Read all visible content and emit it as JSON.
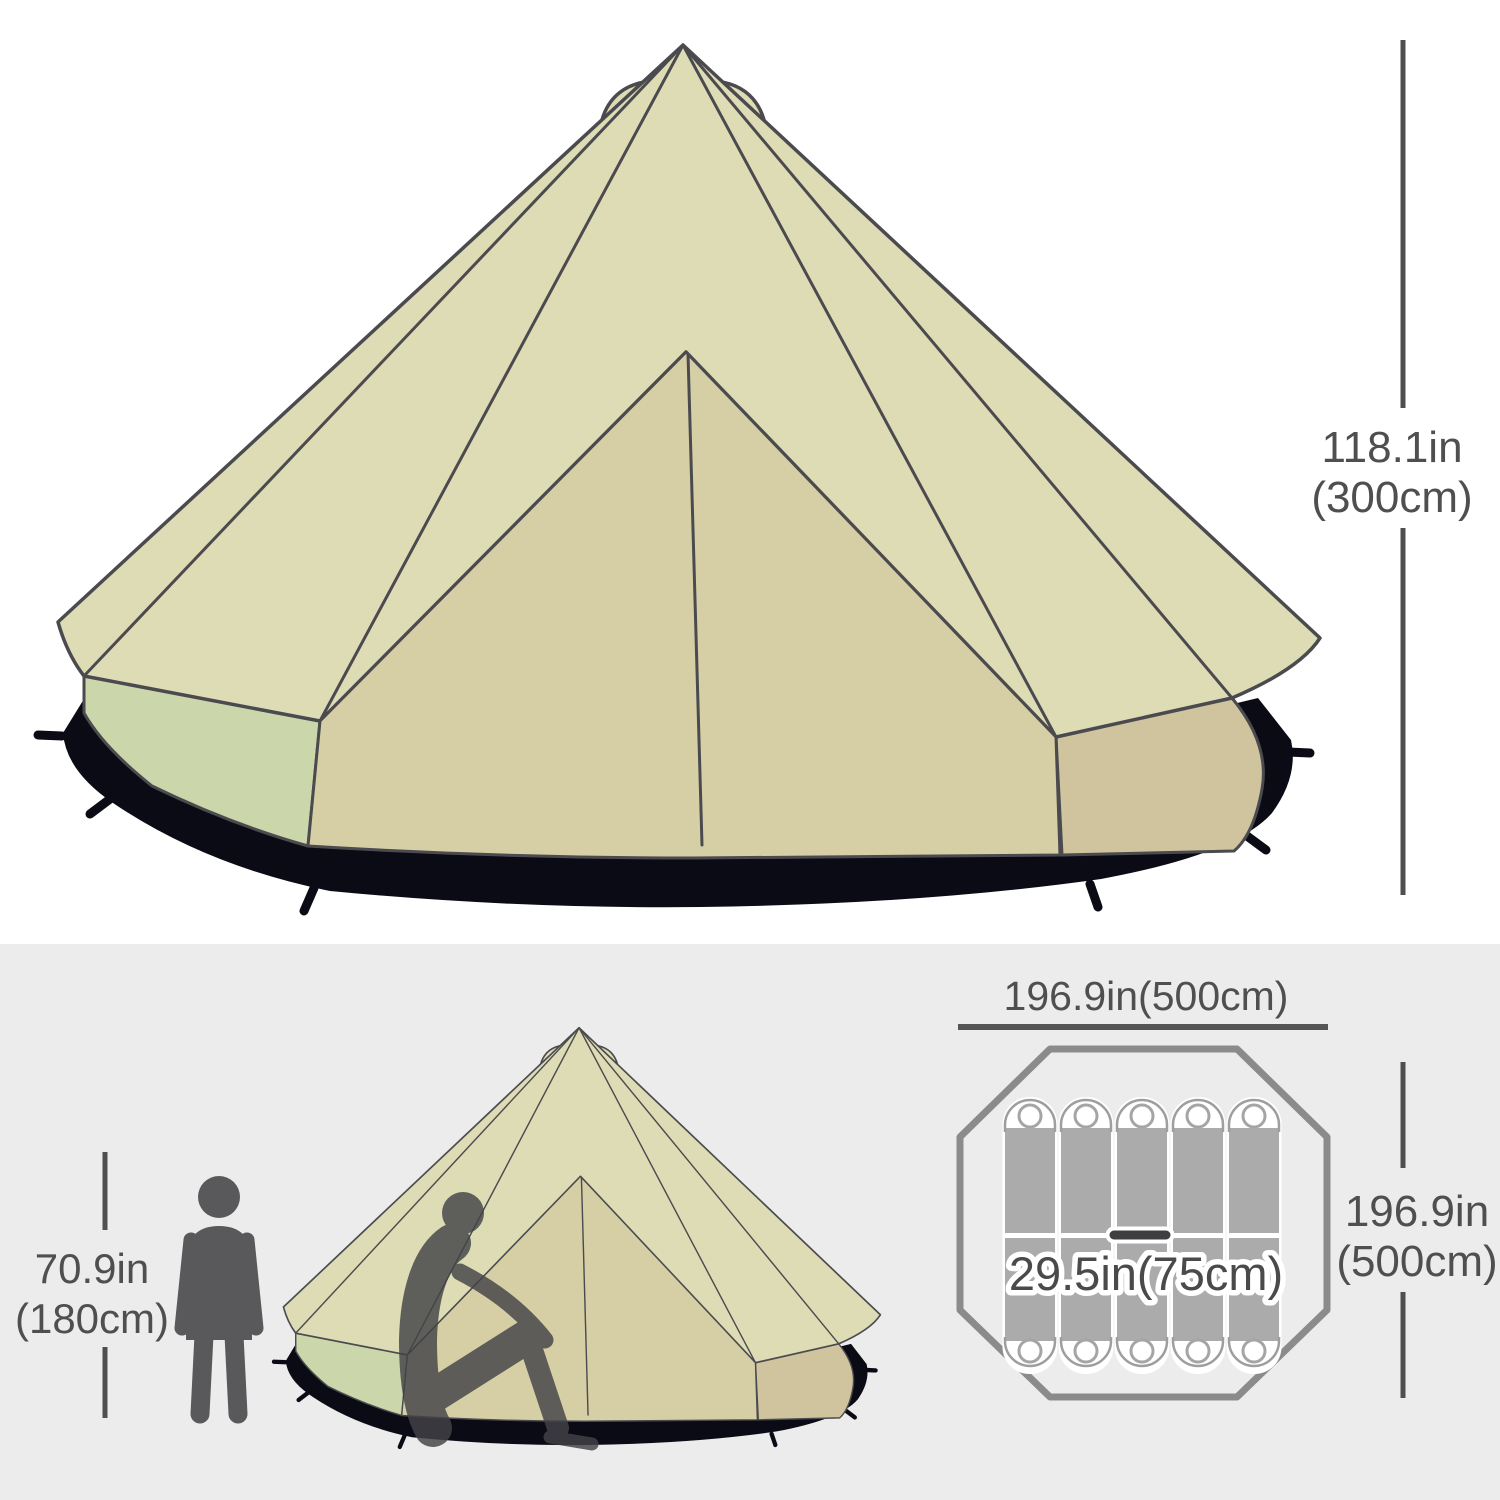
{
  "image": {
    "description": "Bell tent camping tent dimension diagram with side view, human height comparison and top-down floor plan"
  },
  "colors": {
    "canvas": "#dedcb5",
    "front": "#d6cfa6",
    "wall_right": "#cfc49e",
    "wall_green": "#cbd6aa",
    "ground": "#0b0b15",
    "outline": "#4b4b4f",
    "dimension": "#4f4f4f",
    "background_bottom": "#ececec",
    "octagon": "#8b8b8b",
    "pad_body": "#ababab",
    "pad_cap": "#ffffff",
    "person": "#59595b"
  },
  "labels": {
    "tent_height_in": "118.1in",
    "tent_height_cm": "(300cm)",
    "person_height_in": "70.9in",
    "person_height_cm": "(180cm)",
    "floor_width": "196.9in(500cm)",
    "floor_depth_in": "196.9in",
    "floor_depth_cm": "(500cm)",
    "pad_width": "29.5in(75cm)"
  },
  "floor_plan": {
    "pad_columns": 5,
    "pad_rows": 2,
    "total_sleeping_pads": 10
  }
}
